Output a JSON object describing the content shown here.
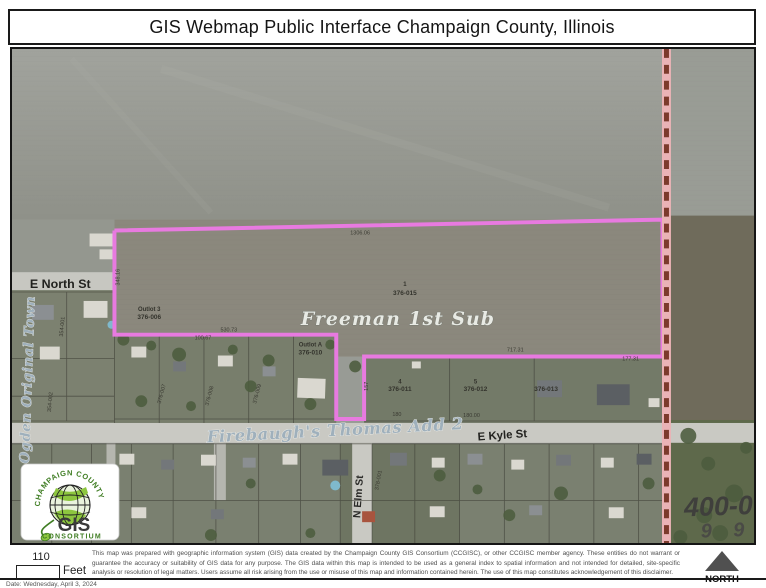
{
  "header": {
    "title": "GIS Webmap Public Interface Champaign County, Illinois"
  },
  "map": {
    "highlight_color": "#e87ae0",
    "county_line_band_color": "#eab3b6",
    "county_line_dash_color": "#7c3a2c",
    "subdivisions": {
      "freeman": "Freeman 1st Sub",
      "firebaugh": "Firebaugh's Thomas Add 2",
      "ogden": "Ogden Original Town"
    },
    "streets": {
      "north": "E North St",
      "kyle": "E Kyle St",
      "elm": "N Elm St"
    },
    "parcels": [
      {
        "lot": "1",
        "id": "376-015"
      },
      {
        "lot": "Outlot 3",
        "id": "376-006"
      },
      {
        "lot": "Outlot A",
        "id": "376-010"
      },
      {
        "lot": "4",
        "id": "376-011"
      },
      {
        "lot": "5",
        "id": "376-012"
      },
      {
        "lot": "",
        "id": "376-013"
      }
    ],
    "small_parcel_ids": [
      "354-001",
      "354-002",
      "376-007",
      "376-008",
      "376-009",
      "378-001"
    ],
    "dimensions": [
      "1306.06",
      "348.16",
      "530.73",
      "100.67",
      "717.31",
      "157",
      "177.31",
      "180",
      "180.00"
    ],
    "corner_label": {
      "line1": "400-0",
      "line2": "9 9"
    }
  },
  "logo": {
    "arc_text": "CHAMPAIGN COUNTY",
    "gis": "GIS",
    "consortium": "CONSORTIUM"
  },
  "footer": {
    "scale_value": "110",
    "scale_unit": "Feet",
    "disclaimer": "This map was prepared with geographic information system (GIS) data created by the Champaign County GIS Consortium (CCGISC), or other CCGISC member agency. These entities do not warrant or guarantee the accuracy or suitability of GIS data for any purpose. The GIS data within this map is intended to be used as a general index to spatial information and not intended for detailed, site-specific analysis or resolution of legal matters. Users assume all risk arising from the use or misuse of this map and information contained herein. The use of this map constitutes acknowledgement of this disclaimer.",
    "north_label": "NORTH",
    "date_line": "Date: Wednesday, April 3, 2024"
  }
}
